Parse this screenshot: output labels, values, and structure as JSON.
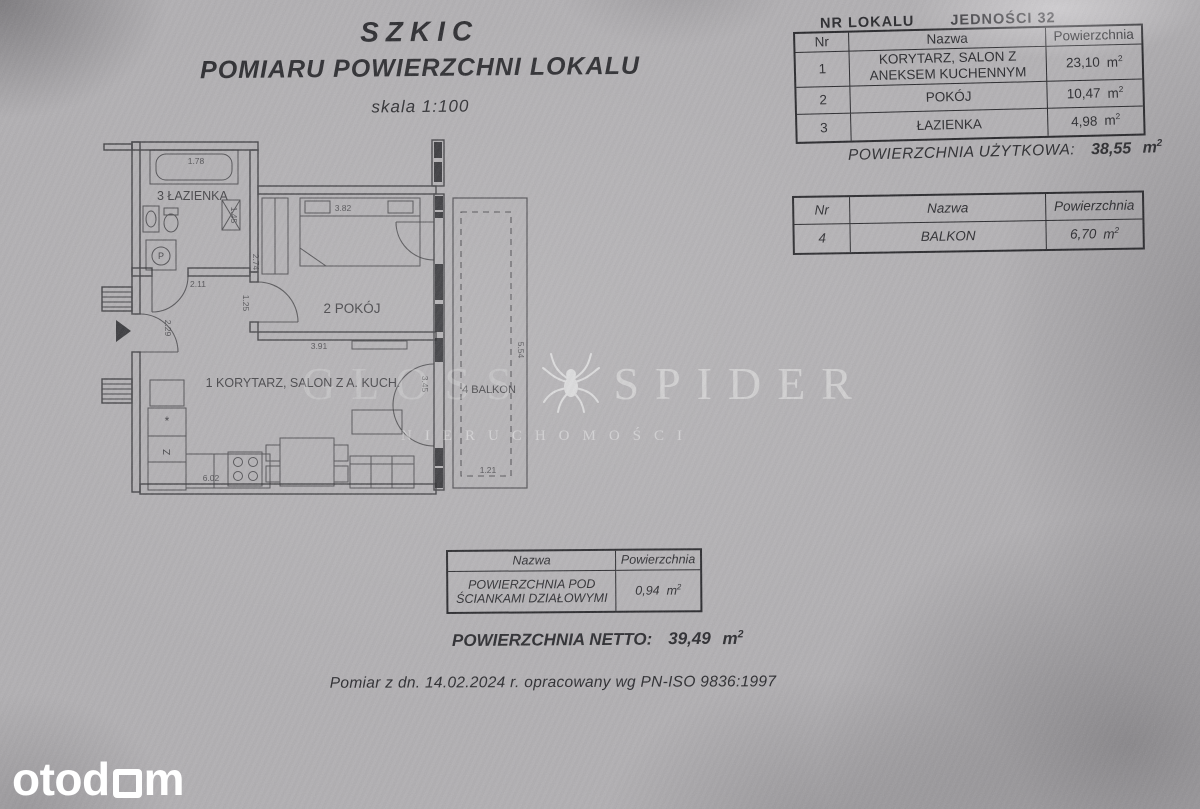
{
  "title": {
    "line1": "SZKIC",
    "line2": "POMIARU POWIERZCHNI LOKALU",
    "scale": "skala 1:100"
  },
  "unit_header": {
    "label": "NR LOKALU",
    "value": "JEDNOŚCI 32"
  },
  "units": {
    "m": "m",
    "exp": "2"
  },
  "table_rooms": {
    "columns": [
      "Nr",
      "Nazwa",
      "Powierzchnia"
    ],
    "rows": [
      {
        "nr": "1",
        "nazwa": "KORYTARZ, SALON Z ANEKSEM KUCHENNYM",
        "area": "23,10"
      },
      {
        "nr": "2",
        "nazwa": "POKÓJ",
        "area": "10,47"
      },
      {
        "nr": "3",
        "nazwa": "ŁAZIENKA",
        "area": "4,98"
      }
    ],
    "total_label": "POWIERZCHNIA UŻYTKOWA:",
    "total_value": "38,55"
  },
  "table_balcony": {
    "columns": [
      "Nr",
      "Nazwa",
      "Powierzchnia"
    ],
    "rows": [
      {
        "nr": "4",
        "nazwa": "BALKON",
        "area": "6,70"
      }
    ]
  },
  "table_partitions": {
    "columns": [
      "Nazwa",
      "Powierzchnia"
    ],
    "rows": [
      {
        "nazwa": "POWIERZCHNIA POD ŚCIANKAMI DZIAŁOWYMI",
        "area": "0,94"
      }
    ]
  },
  "netto": {
    "label": "POWIERZCHNIA NETTO:",
    "value": "39,49"
  },
  "footnote": "Pomiar z dn. 14.02.2024 r. opracowany wg PN-ISO 9836:1997",
  "watermark": {
    "word1": "GLOSS",
    "word2": "SPIDER",
    "subtitle": "NIERUCHOMOŚCI"
  },
  "brand": {
    "pre": "otod",
    "post": "m"
  },
  "plan": {
    "rooms": {
      "bathroom": "3 ŁAZIENKA",
      "bedroom": "2 POKÓJ",
      "living": "1 KORYTARZ, SALON Z A. KUCH.",
      "balcony": "4 BALKON"
    },
    "appliances": {
      "washer": "P",
      "fridge": "Z",
      "hob_mark": "*"
    },
    "dims": {
      "bath_tub": "1.78",
      "hall_w": "2.11",
      "hall_h": "2.29",
      "shaft": "1.45",
      "bedroom_wall": "2.74",
      "bedroom_door": "1.25",
      "bedroom_w": "3.82",
      "bedroom_bottom": "3.91",
      "balcony_door": "3.45",
      "living_w": "6.02",
      "balcony_h": "5.54",
      "balcony_w": "1.21"
    }
  },
  "colors": {
    "paper": "#b1afb2",
    "ink": "#26262a",
    "logo_white": "#ffffff"
  }
}
